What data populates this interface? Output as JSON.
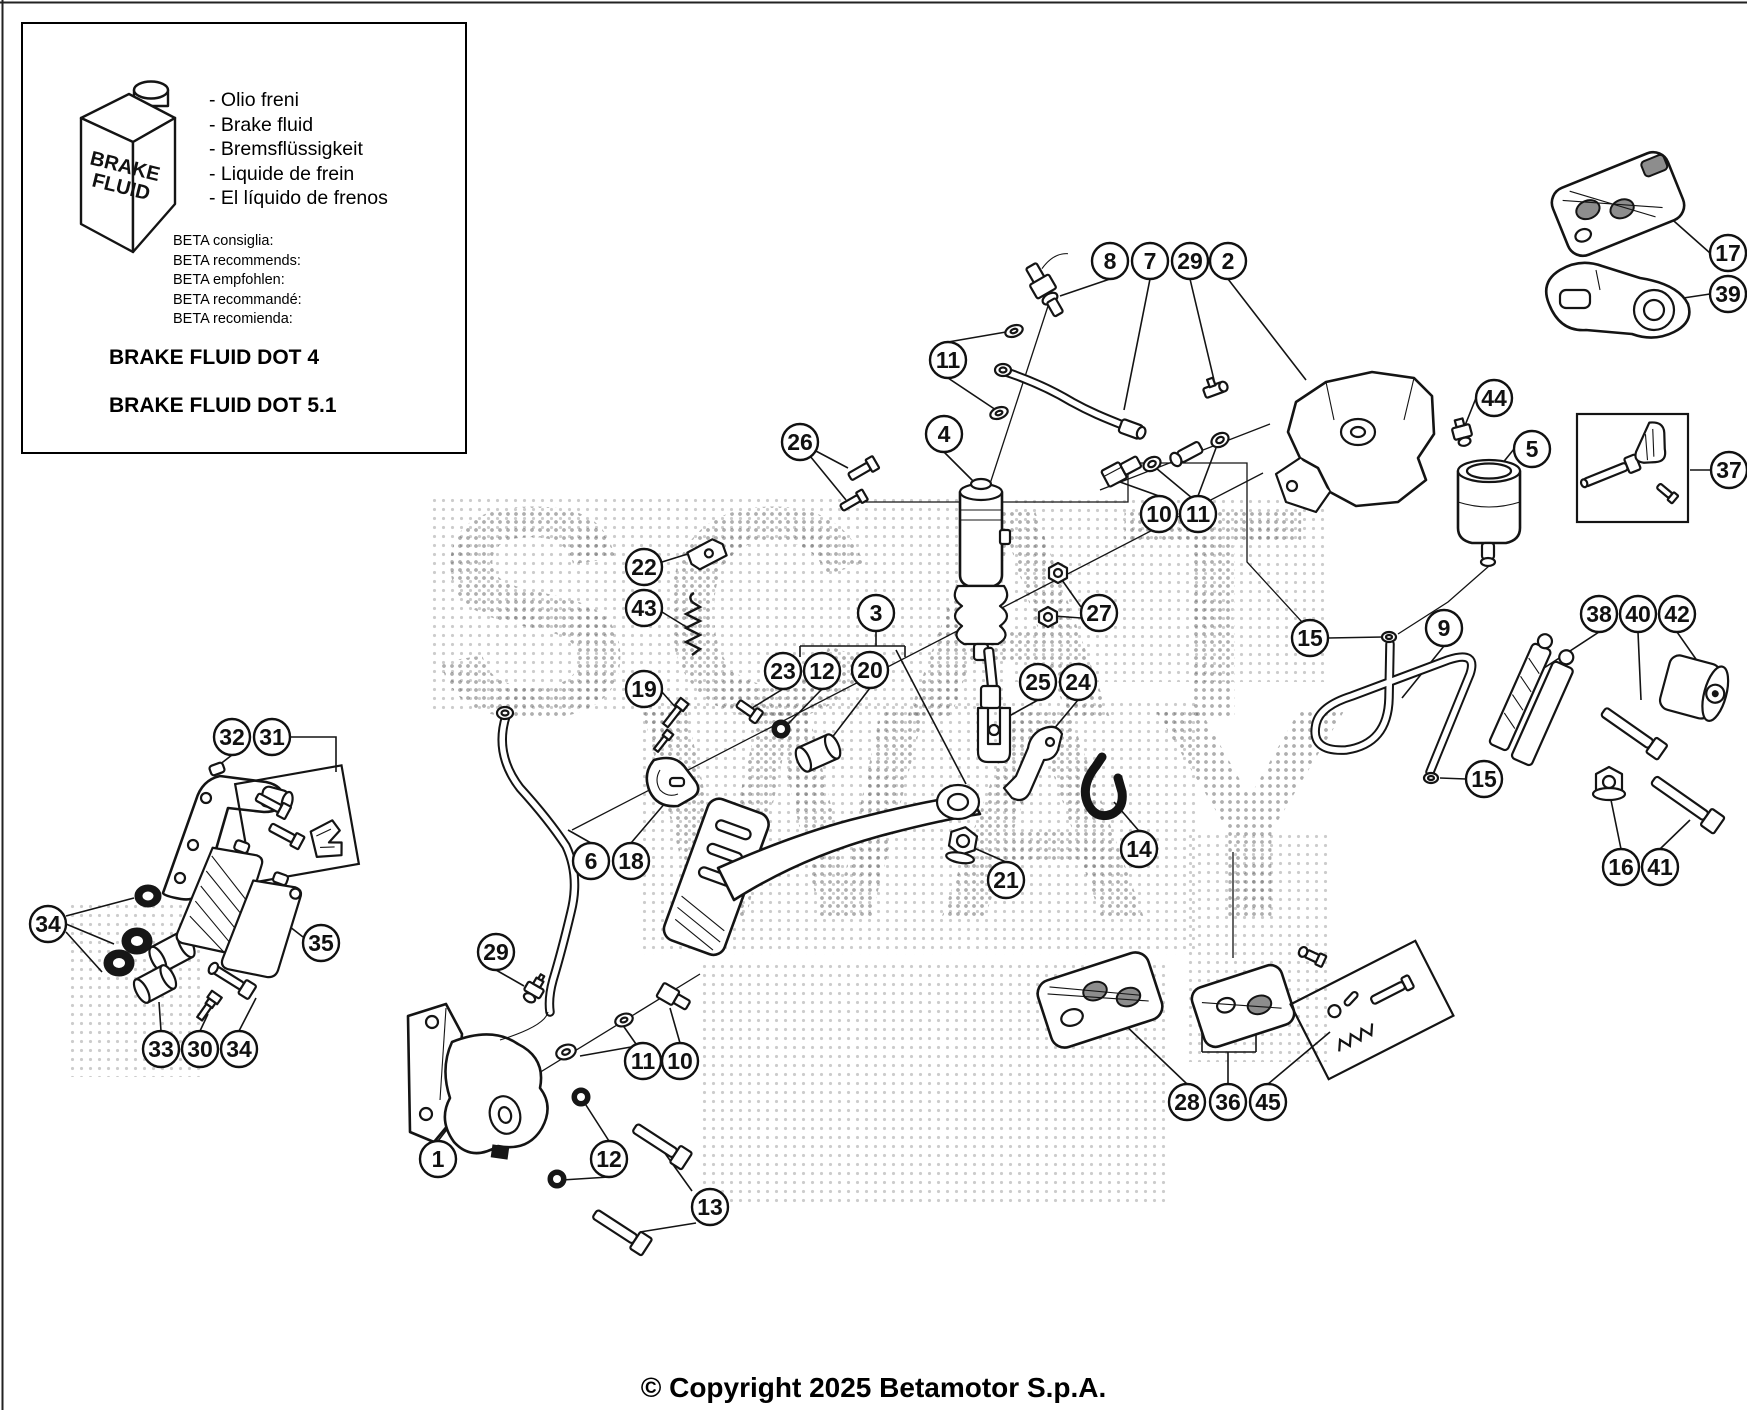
{
  "page": {
    "copyright": "© Copyright 2025 Betamotor S.p.A."
  },
  "info_box": {
    "bottle_label": [
      "BRAKE",
      "FLUID"
    ],
    "fluid_names": [
      "- Olio freni",
      "- Brake fluid",
      "- Bremsflüssigkeit",
      "- Liquide de frein",
      "- El líquido de frenos"
    ],
    "recommendations": [
      "BETA consiglia:",
      "BETA recommends:",
      "BETA empfohlen:",
      "BETA recommandé:",
      "BETA recomienda:"
    ],
    "spec_lines": [
      "BRAKE FLUID DOT 4",
      "BRAKE FLUID DOT 5.1"
    ]
  },
  "watermark": {
    "lines": [
      "SCAT",
      "WAY"
    ]
  },
  "diagram": {
    "line_color": "#141414",
    "callouts": [
      {
        "n": "8",
        "x": 1110,
        "y": 261
      },
      {
        "n": "7",
        "x": 1150,
        "y": 261
      },
      {
        "n": "29",
        "x": 1190,
        "y": 261
      },
      {
        "n": "2",
        "x": 1228,
        "y": 261
      },
      {
        "n": "17",
        "x": 1728,
        "y": 253
      },
      {
        "n": "39",
        "x": 1728,
        "y": 294
      },
      {
        "n": "11",
        "x": 948,
        "y": 360
      },
      {
        "n": "4",
        "x": 944,
        "y": 434
      },
      {
        "n": "26",
        "x": 800,
        "y": 442
      },
      {
        "n": "44",
        "x": 1494,
        "y": 398
      },
      {
        "n": "5",
        "x": 1532,
        "y": 449
      },
      {
        "n": "37",
        "x": 1729,
        "y": 470
      },
      {
        "n": "10",
        "x": 1159,
        "y": 514
      },
      {
        "n": "11",
        "x": 1198,
        "y": 514
      },
      {
        "n": "22",
        "x": 644,
        "y": 567
      },
      {
        "n": "43",
        "x": 644,
        "y": 608
      },
      {
        "n": "27",
        "x": 1099,
        "y": 613
      },
      {
        "n": "3",
        "x": 876,
        "y": 613
      },
      {
        "n": "15",
        "x": 1310,
        "y": 638
      },
      {
        "n": "9",
        "x": 1444,
        "y": 628
      },
      {
        "n": "38",
        "x": 1599,
        "y": 614
      },
      {
        "n": "40",
        "x": 1638,
        "y": 614
      },
      {
        "n": "42",
        "x": 1677,
        "y": 614
      },
      {
        "n": "23",
        "x": 783,
        "y": 671
      },
      {
        "n": "12",
        "x": 822,
        "y": 671
      },
      {
        "n": "20",
        "x": 870,
        "y": 670
      },
      {
        "n": "19",
        "x": 644,
        "y": 689
      },
      {
        "n": "25",
        "x": 1038,
        "y": 682
      },
      {
        "n": "24",
        "x": 1078,
        "y": 682
      },
      {
        "n": "32",
        "x": 232,
        "y": 737
      },
      {
        "n": "31",
        "x": 272,
        "y": 737
      },
      {
        "n": "15",
        "x": 1484,
        "y": 779
      },
      {
        "n": "14",
        "x": 1139,
        "y": 849
      },
      {
        "n": "6",
        "x": 591,
        "y": 861
      },
      {
        "n": "18",
        "x": 631,
        "y": 861
      },
      {
        "n": "16",
        "x": 1621,
        "y": 867
      },
      {
        "n": "41",
        "x": 1660,
        "y": 867
      },
      {
        "n": "21",
        "x": 1006,
        "y": 880
      },
      {
        "n": "34",
        "x": 48,
        "y": 924
      },
      {
        "n": "35",
        "x": 321,
        "y": 943
      },
      {
        "n": "29",
        "x": 496,
        "y": 952
      },
      {
        "n": "33",
        "x": 161,
        "y": 1049
      },
      {
        "n": "30",
        "x": 200,
        "y": 1049
      },
      {
        "n": "34",
        "x": 239,
        "y": 1049
      },
      {
        "n": "11",
        "x": 643,
        "y": 1061
      },
      {
        "n": "10",
        "x": 680,
        "y": 1061
      },
      {
        "n": "28",
        "x": 1187,
        "y": 1102
      },
      {
        "n": "36",
        "x": 1228,
        "y": 1102
      },
      {
        "n": "45",
        "x": 1268,
        "y": 1102
      },
      {
        "n": "1",
        "x": 438,
        "y": 1159
      },
      {
        "n": "12",
        "x": 609,
        "y": 1159
      },
      {
        "n": "13",
        "x": 710,
        "y": 1207
      }
    ]
  }
}
